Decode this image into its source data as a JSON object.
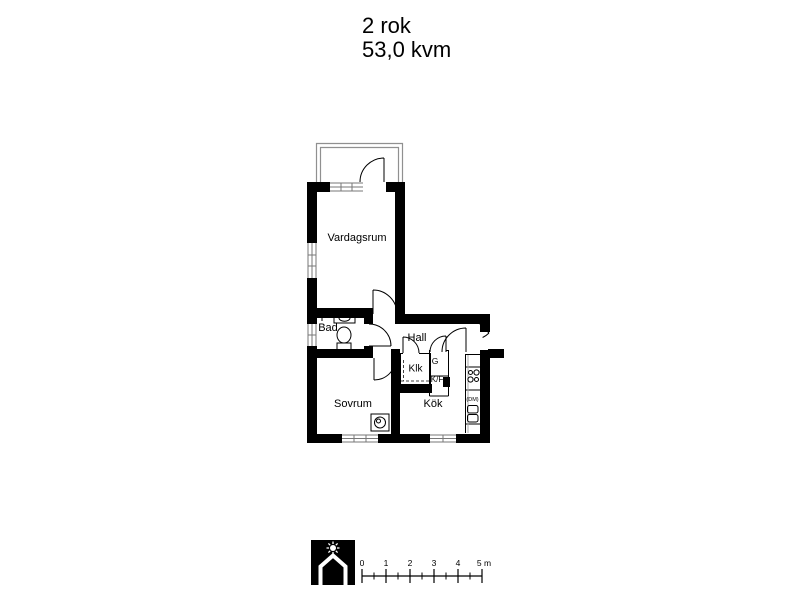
{
  "header": {
    "rooms_line": "2 rok",
    "area_line": "53,0 kvm"
  },
  "floorplan": {
    "labels": {
      "vardagsrum": "Vardagsrum",
      "bad": "Bad",
      "hall": "Hall",
      "sovrum": "Sovrum",
      "kok": "Kök",
      "klk": "Klk",
      "garderob": "G",
      "kyl_frys": "K/F",
      "diskmaskin": "(DM)"
    }
  },
  "scale_bar": {
    "tick_labels": [
      "0",
      "1",
      "2",
      "3",
      "4",
      "5 m"
    ]
  },
  "colors": {
    "wall": "#000000",
    "background": "#ffffff",
    "balcony_line": "#909090",
    "window_line": "#777777"
  }
}
